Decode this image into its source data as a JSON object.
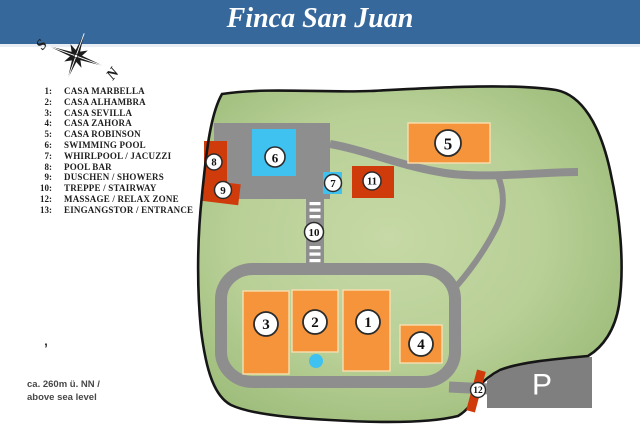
{
  "header": {
    "title": "Finca San Juan",
    "bg_color": "#36689B"
  },
  "compass": {
    "south_label": "S",
    "north_label": "N"
  },
  "legend": {
    "items": [
      {
        "num": "1:",
        "label": "CASA MARBELLA"
      },
      {
        "num": "2:",
        "label": "CASA ALHAMBRA"
      },
      {
        "num": "3:",
        "label": "CASA SEVILLA"
      },
      {
        "num": "4:",
        "label": "CASA ZAHORA"
      },
      {
        "num": "5:",
        "label": "CASA ROBINSON"
      },
      {
        "num": "6:",
        "label": "SWIMMING POOL"
      },
      {
        "num": "7:",
        "label": "WHIRLPOOL / JACUZZI"
      },
      {
        "num": "8:",
        "label": "POOL BAR"
      },
      {
        "num": "9:",
        "label": "DUSCHEN / SHOWERS"
      },
      {
        "num": "10:",
        "label": "TREPPE / STAIRWAY"
      },
      {
        "num": "12:",
        "label": "MASSAGE / RELAX ZONE"
      },
      {
        "num": "13:",
        "label": "EINGANGSTOR / ENTRANCE"
      }
    ]
  },
  "map": {
    "parking_label": "P",
    "markers": {
      "m1": {
        "number": "1"
      },
      "m2": {
        "number": "2"
      },
      "m3": {
        "number": "3"
      },
      "m4": {
        "number": "4"
      },
      "m5": {
        "number": "5"
      },
      "m6": {
        "number": "6"
      },
      "m7": {
        "number": "7"
      },
      "m8": {
        "number": "8"
      },
      "m9": {
        "number": "9"
      },
      "m10": {
        "number": "10"
      },
      "m11": {
        "number": "11"
      },
      "m12": {
        "number": "12"
      }
    },
    "colors": {
      "land_light": "#c6d9a6",
      "land_dark": "#98b975",
      "outline": "#161616",
      "road": "#8e8e8e",
      "building_orange": "#f5943a",
      "water_blue": "#3fc2f0",
      "accent_red": "#d03b0b",
      "parking_gray": "#7f7f7f"
    }
  },
  "footnote": {
    "line1": "ca. 260m ü. NN /",
    "line2": "above sea level"
  },
  "tick": "’"
}
